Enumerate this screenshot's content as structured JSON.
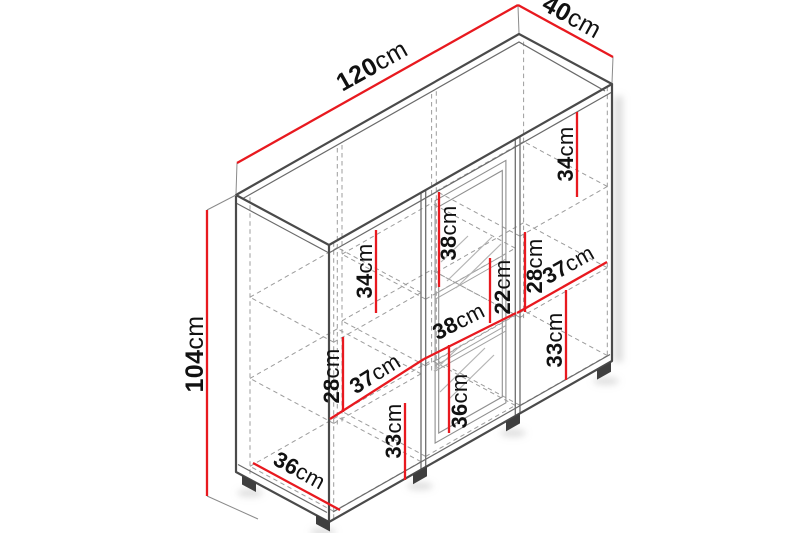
{
  "diagram": {
    "kind": "isometric-furniture-dimension-drawing",
    "colors": {
      "accent": "#e8191f",
      "outline": "#4a4a4a",
      "hidden": "#9c9c9c",
      "text": "#111111"
    },
    "dimensions": {
      "overall_width": {
        "value": "120",
        "unit": "cm"
      },
      "overall_depth": {
        "value": "40",
        "unit": "cm"
      },
      "overall_height": {
        "value": "104",
        "unit": "cm"
      },
      "left_top_compartment_height": {
        "value": "34",
        "unit": "cm"
      },
      "middle_top_compartment_height": {
        "value": "38",
        "unit": "cm"
      },
      "right_top_compartment_height": {
        "value": "34",
        "unit": "cm"
      },
      "left_middle_compartment_height": {
        "value": "28",
        "unit": "cm"
      },
      "middle_middle_compartment_height": {
        "value": "22",
        "unit": "cm"
      },
      "right_middle_compartment_height": {
        "value": "28",
        "unit": "cm"
      },
      "left_bottom_compartment_height": {
        "value": "33",
        "unit": "cm"
      },
      "middle_bottom_compartment_height": {
        "value": "36",
        "unit": "cm"
      },
      "right_bottom_compartment_height": {
        "value": "33",
        "unit": "cm"
      },
      "left_compartment_width": {
        "value": "37",
        "unit": "cm"
      },
      "middle_compartment_width": {
        "value": "38",
        "unit": "cm"
      },
      "right_compartment_width": {
        "value": "37",
        "unit": "cm"
      },
      "interior_depth": {
        "value": "36",
        "unit": "cm"
      }
    }
  }
}
